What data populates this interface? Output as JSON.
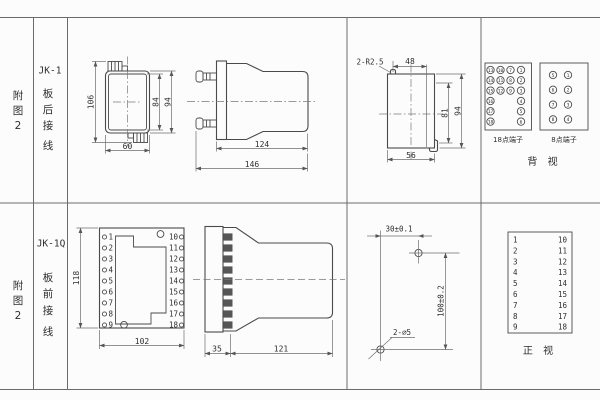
{
  "colors": {
    "line": "#4a4a4a",
    "background": "#fcfcfc",
    "text": "#2e2e2e"
  },
  "row1": {
    "fig": [
      "附",
      "图",
      "2"
    ],
    "model": "JK-1",
    "wiring": [
      "板",
      "后",
      "接",
      "线"
    ],
    "top_view": {
      "h_total": "106",
      "h_inner": "84",
      "h_outer": "94",
      "w": "60"
    },
    "side_view": {
      "body": "124",
      "total": "146"
    },
    "cutout": {
      "corner": "2-R2.5",
      "top": "48",
      "inner": "81",
      "outer": "94",
      "bottom": "56"
    },
    "t18": {
      "label": "18点端子",
      "r0": [
        "13",
        "10",
        "7",
        "1"
      ],
      "r1": [
        "14",
        "11",
        "8",
        "2"
      ],
      "r2": [
        "15",
        "12",
        "9",
        "3"
      ],
      "r3": [
        "16",
        "4"
      ],
      "r4": [
        "17",
        "5"
      ],
      "r5": [
        "18",
        "6"
      ]
    },
    "t8": {
      "label": "8点端子",
      "left": [
        "5",
        "6",
        "7",
        "8"
      ],
      "right": [
        "1",
        "2",
        "3",
        "4"
      ]
    },
    "view": "背 视"
  },
  "row2": {
    "fig": [
      "附",
      "图",
      "2"
    ],
    "model": "JK-1Q",
    "wiring": [
      "板",
      "前",
      "接",
      "线"
    ],
    "front_view": {
      "h": "118",
      "w": "102",
      "left": [
        "1",
        "2",
        "3",
        "4",
        "5",
        "6",
        "7",
        "8",
        "9"
      ],
      "right": [
        "10",
        "11",
        "12",
        "13",
        "14",
        "15",
        "16",
        "17",
        "18"
      ]
    },
    "side_view": {
      "plate": "35",
      "body": "121"
    },
    "drill": {
      "h": "30±0.1",
      "v": "100±0.2",
      "holes": "2-∅5"
    },
    "table": {
      "left": [
        "1",
        "2",
        "3",
        "4",
        "5",
        "6",
        "7",
        "8",
        "9"
      ],
      "right": [
        "10",
        "11",
        "12",
        "13",
        "14",
        "15",
        "16",
        "17",
        "18"
      ],
      "view": "正 视"
    }
  }
}
